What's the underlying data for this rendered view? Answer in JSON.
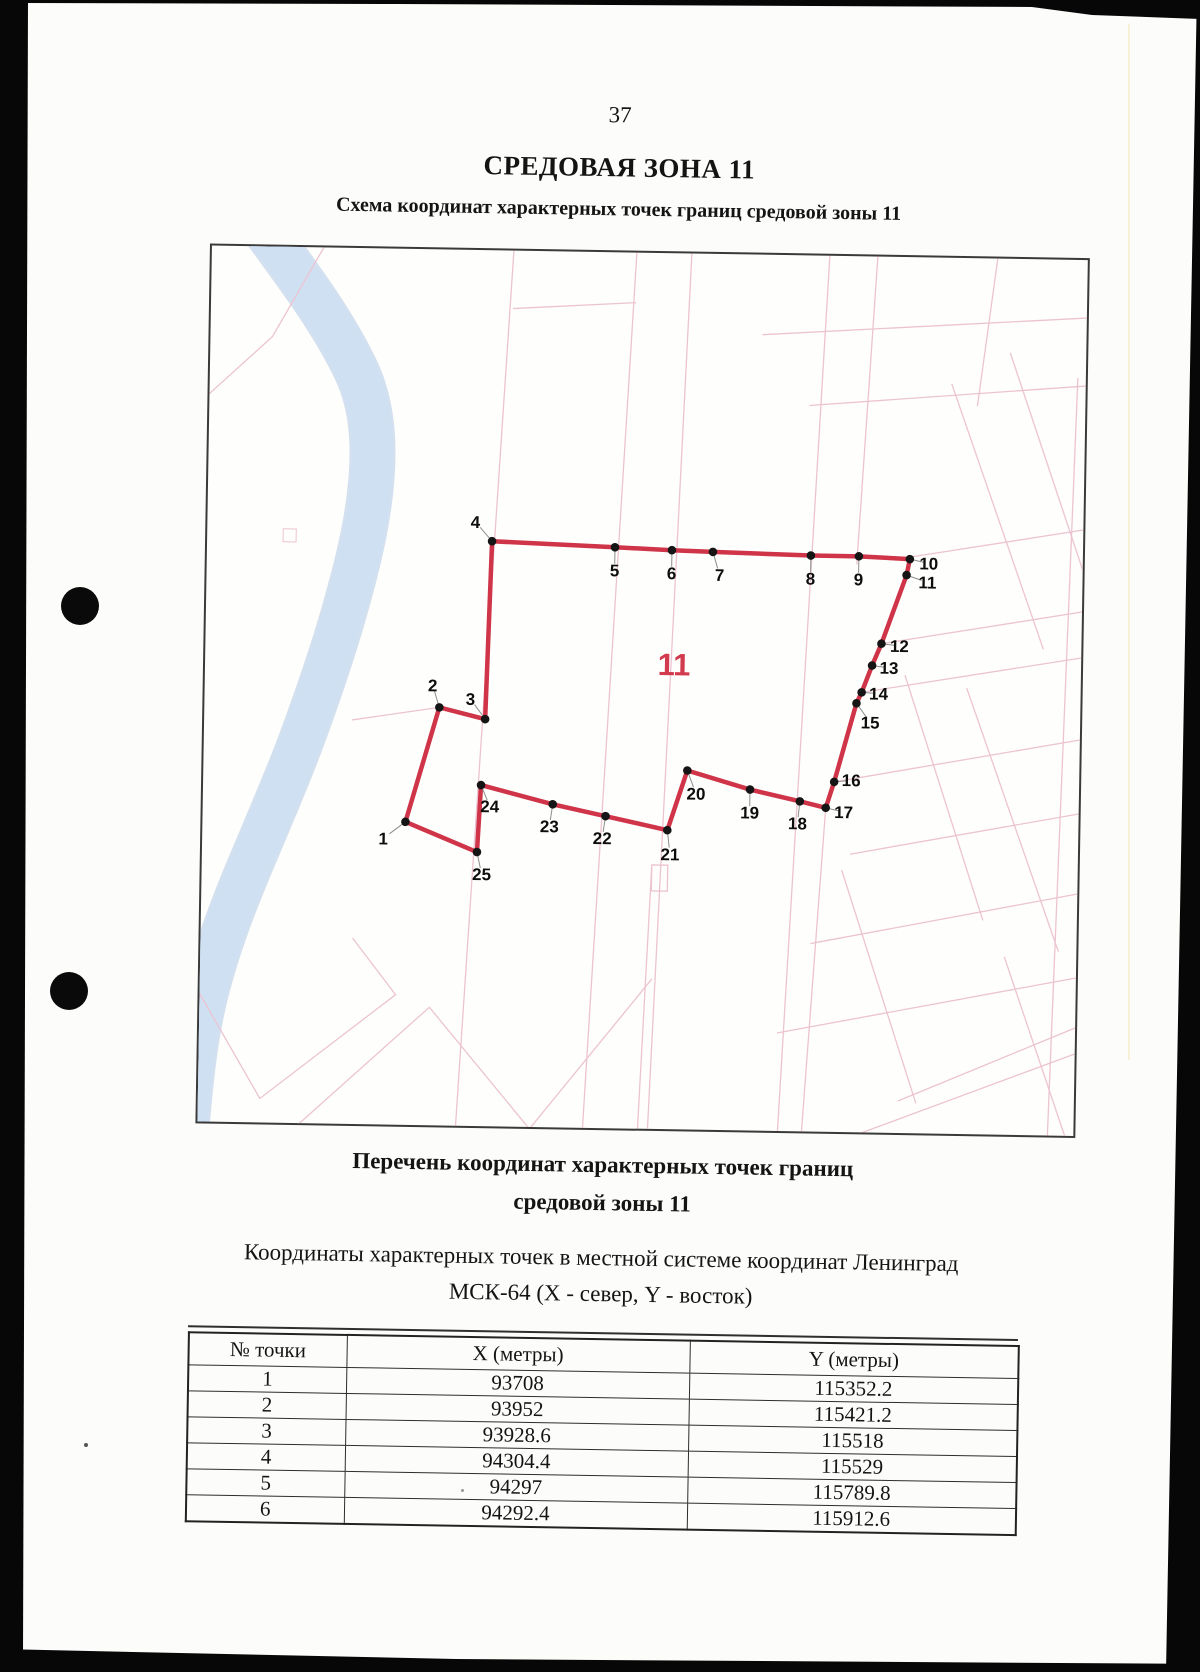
{
  "page": {
    "number": "37"
  },
  "header": {
    "title": "СРЕДОВАЯ ЗОНА 11",
    "subtitle": "Схема координат характерных точек границ средовой зоны 11"
  },
  "map": {
    "zone_label": "11",
    "colors": {
      "boundary": "#cf3448",
      "zone_label": "#d23a4e",
      "river": "#cfe0f2",
      "river_edge": "#aec6e4",
      "cadastral": "#ecc3d2"
    },
    "points": [
      {
        "n": "1",
        "x": 203,
        "y": 573,
        "lx": 181,
        "ly": 590
      },
      {
        "n": "2",
        "x": 235,
        "y": 458,
        "lx": 228,
        "ly": 436
      },
      {
        "n": "3",
        "x": 281,
        "y": 469,
        "lx": 266,
        "ly": 449
      },
      {
        "n": "4",
        "x": 285,
        "y": 291,
        "lx": 268,
        "ly": 272
      },
      {
        "n": "5",
        "x": 408,
        "y": 295,
        "lx": 408,
        "ly": 318
      },
      {
        "n": "6",
        "x": 465,
        "y": 297,
        "lx": 465,
        "ly": 320
      },
      {
        "n": "7",
        "x": 506,
        "y": 298,
        "lx": 513,
        "ly": 321
      },
      {
        "n": "8",
        "x": 604,
        "y": 300,
        "lx": 604,
        "ly": 323
      },
      {
        "n": "9",
        "x": 652,
        "y": 300,
        "lx": 652,
        "ly": 323
      },
      {
        "n": "10",
        "x": 703,
        "y": 302,
        "lx": 722,
        "ly": 306
      },
      {
        "n": "11",
        "x": 700,
        "y": 318,
        "lx": 721,
        "ly": 325
      },
      {
        "n": "12",
        "x": 676,
        "y": 387,
        "lx": 694,
        "ly": 389
      },
      {
        "n": "13",
        "x": 667,
        "y": 409,
        "lx": 684,
        "ly": 411
      },
      {
        "n": "14",
        "x": 657,
        "y": 436,
        "lx": 674,
        "ly": 437
      },
      {
        "n": "15",
        "x": 652,
        "y": 447,
        "lx": 666,
        "ly": 466
      },
      {
        "n": "16",
        "x": 631,
        "y": 526,
        "lx": 648,
        "ly": 524
      },
      {
        "n": "17",
        "x": 623,
        "y": 552,
        "lx": 641,
        "ly": 556
      },
      {
        "n": "18",
        "x": 597,
        "y": 546,
        "lx": 595,
        "ly": 568
      },
      {
        "n": "19",
        "x": 547,
        "y": 535,
        "lx": 547,
        "ly": 558
      },
      {
        "n": "20",
        "x": 484,
        "y": 517,
        "lx": 493,
        "ly": 540
      },
      {
        "n": "21",
        "x": 465,
        "y": 577,
        "lx": 468,
        "ly": 601
      },
      {
        "n": "22",
        "x": 403,
        "y": 564,
        "lx": 400,
        "ly": 586
      },
      {
        "n": "23",
        "x": 350,
        "y": 553,
        "lx": 347,
        "ly": 575
      },
      {
        "n": "24",
        "x": 278,
        "y": 535,
        "lx": 287,
        "ly": 556
      },
      {
        "n": "25",
        "x": 275,
        "y": 602,
        "lx": 280,
        "ly": 624
      }
    ]
  },
  "list": {
    "heading_line1": "Перечень координат характерных точек границ",
    "heading_line2": "средовой зоны 11",
    "intro_line1": "Координаты характерных точек в местной системе координат Ленинград",
    "intro_line2": "МСК-64 (X - север, Y - восток)"
  },
  "table": {
    "headers": [
      "№ точки",
      "X (метры)",
      "Y (метры)"
    ],
    "rows": [
      [
        "1",
        "93708",
        "115352.2"
      ],
      [
        "2",
        "93952",
        "115421.2"
      ],
      [
        "3",
        "93928.6",
        "115518"
      ],
      [
        "4",
        "94304.4",
        "115529"
      ],
      [
        "5",
        "94297",
        "115789.8"
      ],
      [
        "6",
        "94292.4",
        "115912.6"
      ]
    ]
  }
}
